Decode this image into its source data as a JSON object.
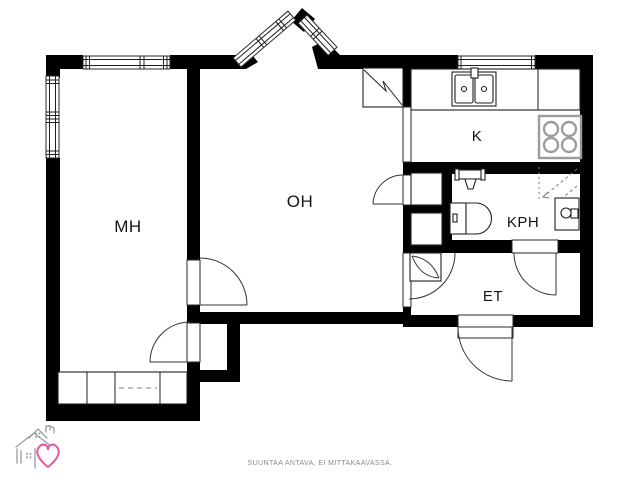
{
  "floor_plan": {
    "title": "apartment-floor-plan",
    "rooms": {
      "bedroom": "MH",
      "living_room": "OH",
      "kitchen": "K",
      "bathroom": "KPH",
      "hallway": "ET"
    },
    "footer_note": "SUUNTAA ANTAVA, EI MITTAKAAVASSA.",
    "symbols": {
      "stove-icon": "square with four burner circles",
      "kitchen-sink-icon": "double basin with faucet",
      "bathroom-sink-icon": "wall basin with tap",
      "toilet-icon": "cistern with D-shaped bowl",
      "washing-machine-icon": "box with drum circle",
      "shower-icon": "dashed corner arrows",
      "wardrobe-icon": "divided box row with sliding-door dashes",
      "flue-icon": "square with zigzag diagonal",
      "house-heart-logo": "line-drawn house with pink heart"
    },
    "colors": {
      "wall_black": "#000000",
      "fixture_gray": "#9b9b9b",
      "footer_text_gray": "#8a8a8a",
      "logo_gray": "#9ba2a9",
      "logo_heart_pink": "#e7569e"
    }
  }
}
